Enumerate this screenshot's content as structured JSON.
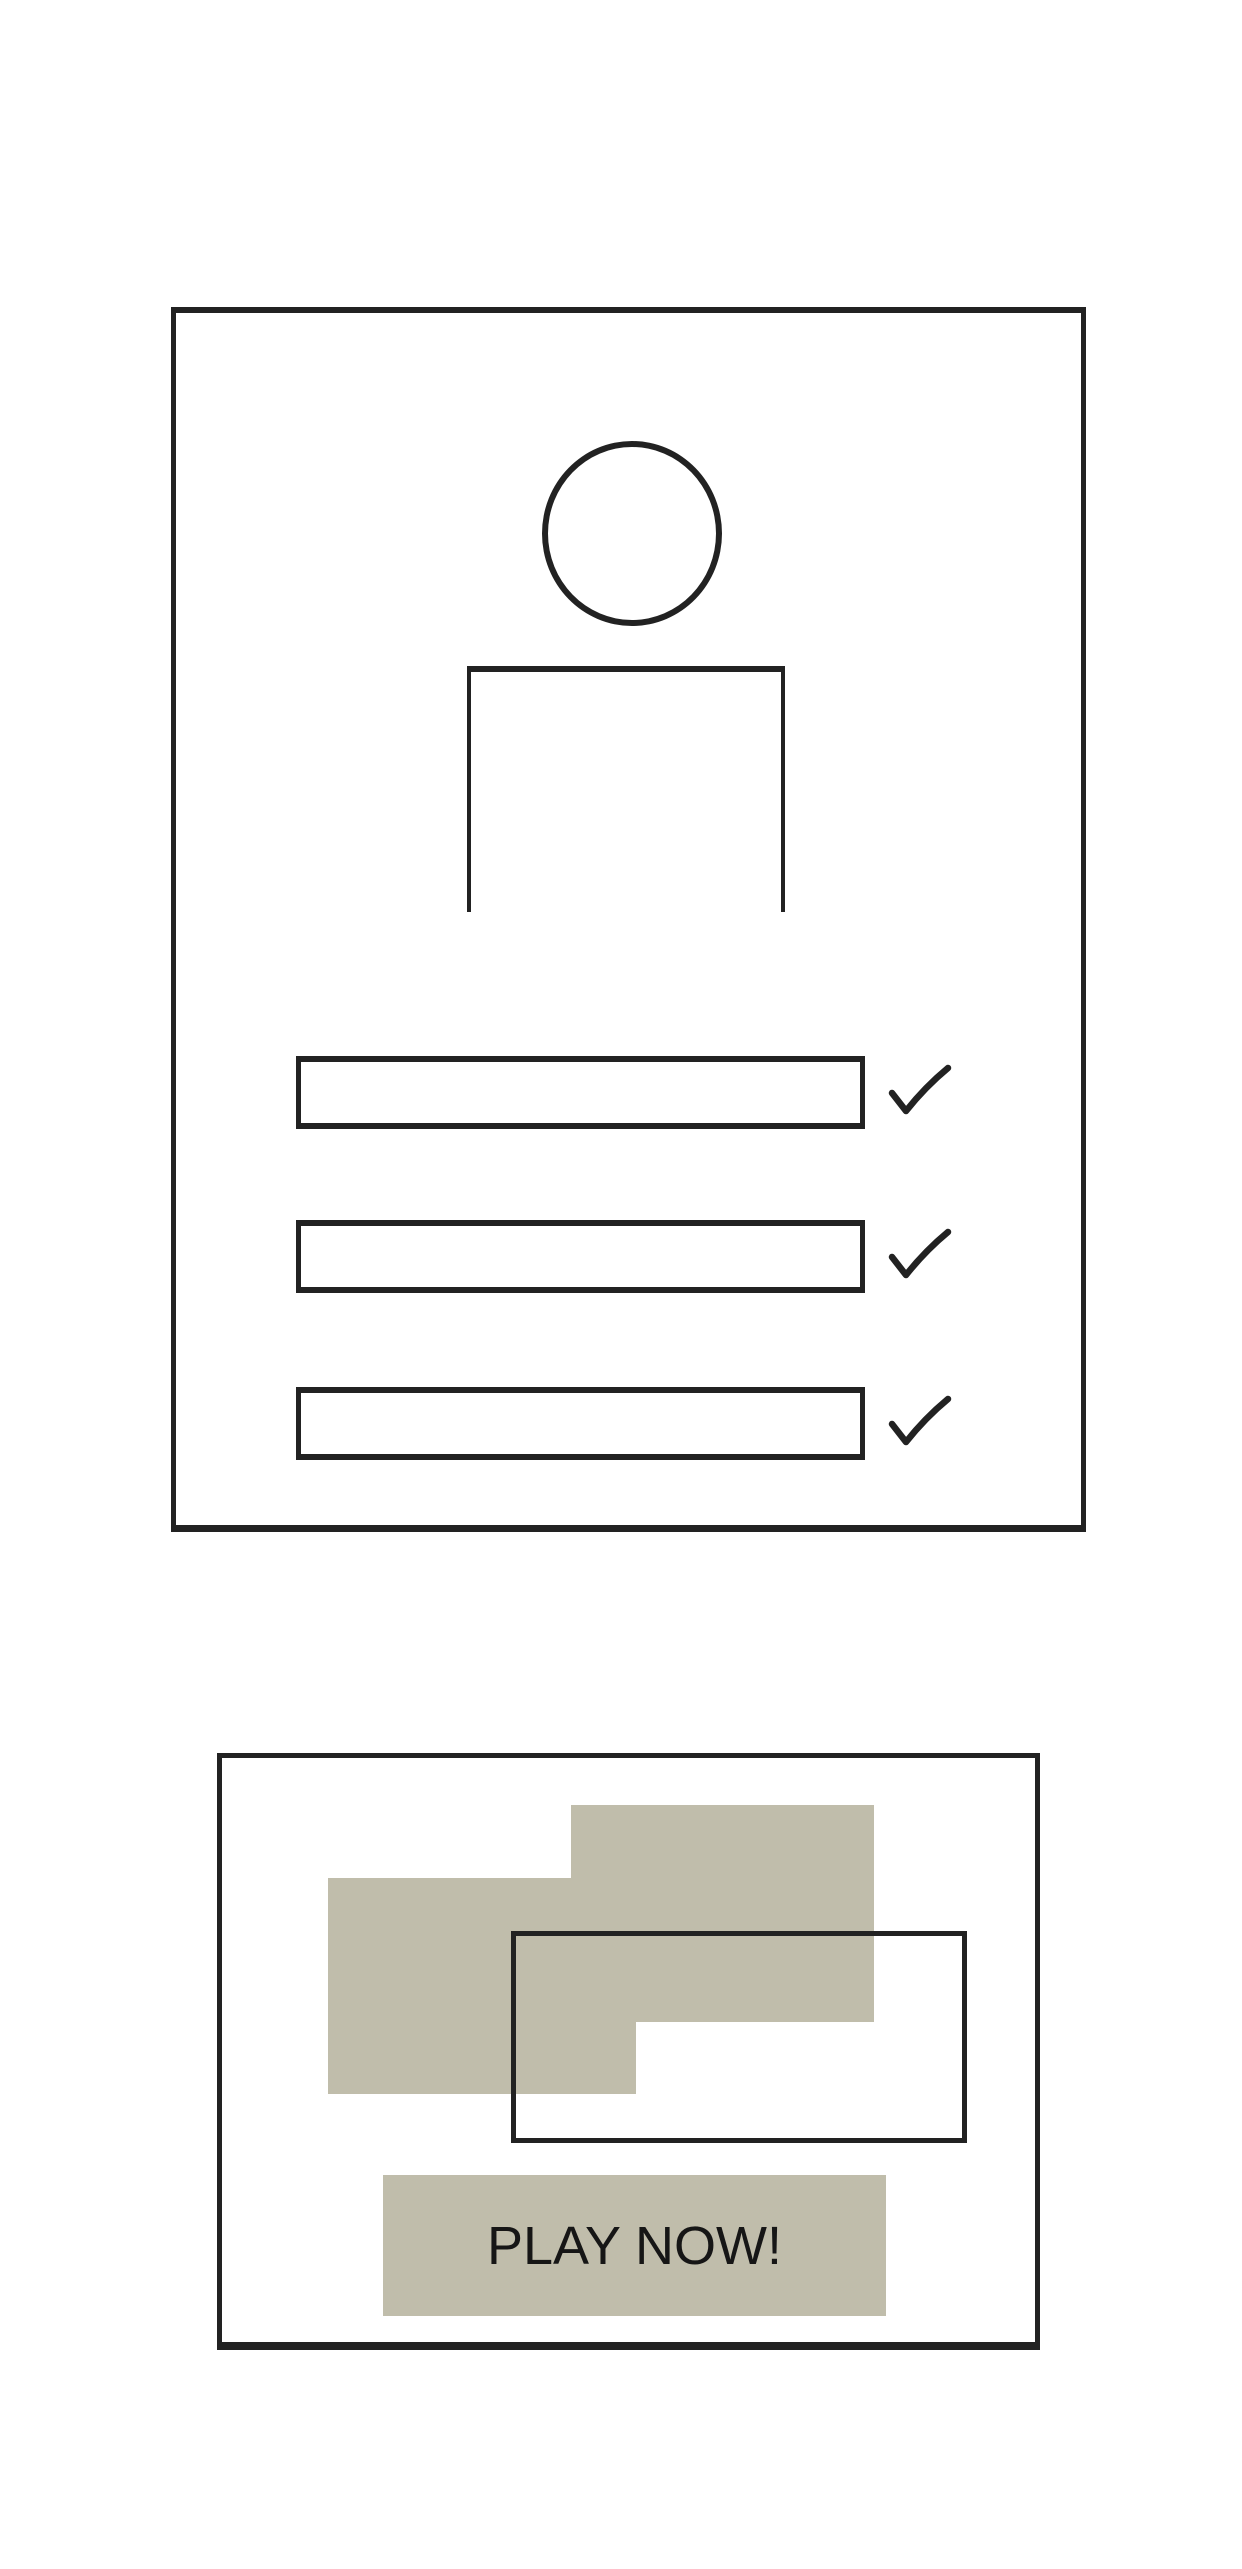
{
  "theme": {
    "ink": "#222222",
    "khaki": "#c0bdab",
    "paper": "#ffffff",
    "text": "#161616"
  },
  "profile_card": {
    "avatar": {
      "icon": "person-icon"
    },
    "checklist": {
      "check_icon": "checkmark-icon",
      "rows": [
        {
          "value": "",
          "checked": true
        },
        {
          "value": "",
          "checked": true
        },
        {
          "value": "",
          "checked": true
        }
      ]
    }
  },
  "promo_card": {
    "image_placeholder": {
      "blocks": 2,
      "outline_rect": 1
    },
    "play_button": {
      "label": "PLAY NOW!"
    }
  }
}
